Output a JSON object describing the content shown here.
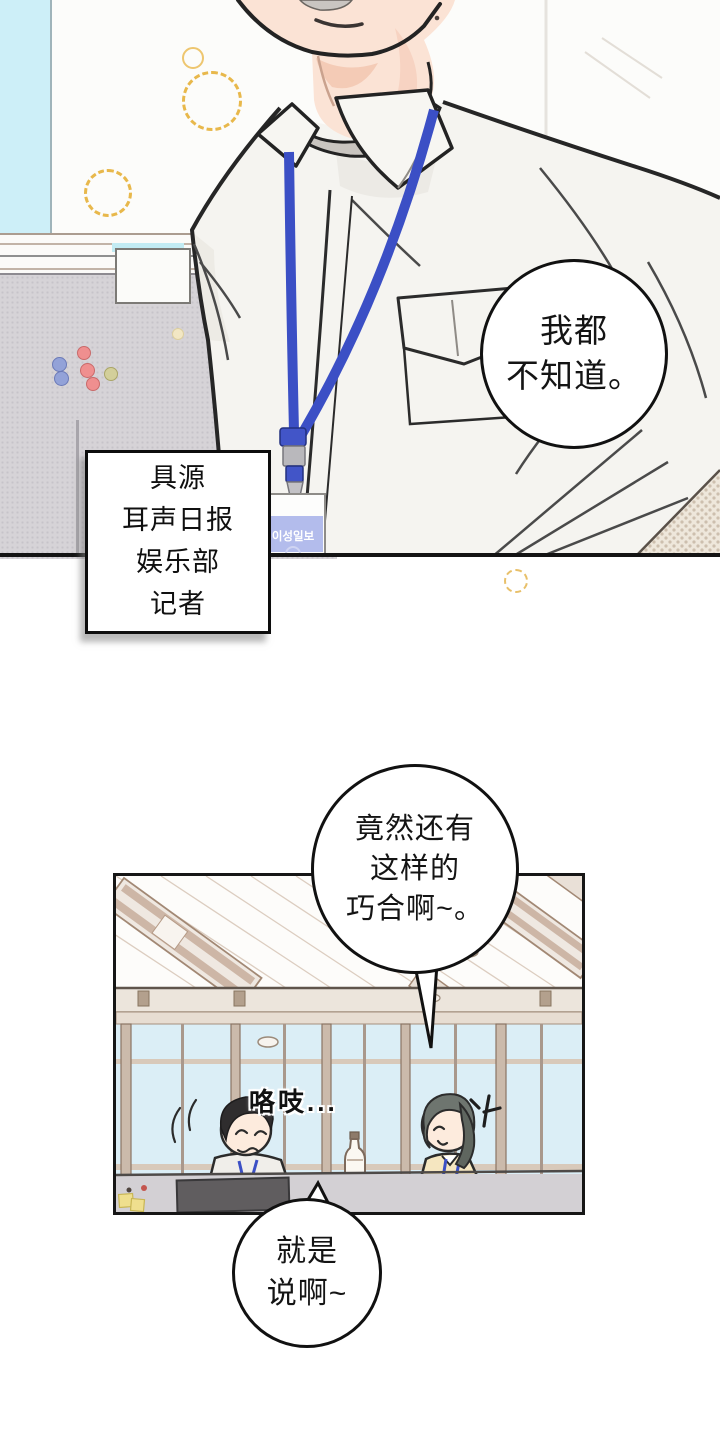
{
  "page": {
    "kind": "webtoon comic page, two panels"
  },
  "panel1": {
    "speech_bubble": {
      "lines": [
        "我都",
        "不知道。"
      ]
    },
    "caption_box": {
      "lines": [
        "具源",
        "耳声日报",
        "娱乐部",
        "记者"
      ]
    },
    "badge": {
      "text": "이성일보"
    }
  },
  "panel2": {
    "speech_bubble": {
      "lines": [
        "竟然还有",
        "这样的",
        "巧合啊~。"
      ]
    },
    "sfx": "咯吱...",
    "bottom_bubble": {
      "lines": [
        "就是",
        "说啊~"
      ]
    }
  },
  "colors": {
    "lanyard_blue": "#3b4fc5",
    "badge_band_lavender": "#b3bcec",
    "window_strip_cyan": "#cdeff8",
    "office_window_blue": "#dbeef6",
    "sparkle_yellow": "#e8b84b",
    "partition_gray": "#d6d3d7",
    "desk_gray": "#d3d0d4",
    "sticky_note_yellow": "#efdf8e",
    "skin": "#fbe3d5",
    "shirt": "#f5f4f0",
    "hair_man": "#2f2d2e",
    "hair_woman": "#6e756f",
    "outline": "#232323",
    "pin_blue": "#93a2d8",
    "pin_red": "#ef8f8f",
    "pin_green": "#d3cf9a"
  }
}
